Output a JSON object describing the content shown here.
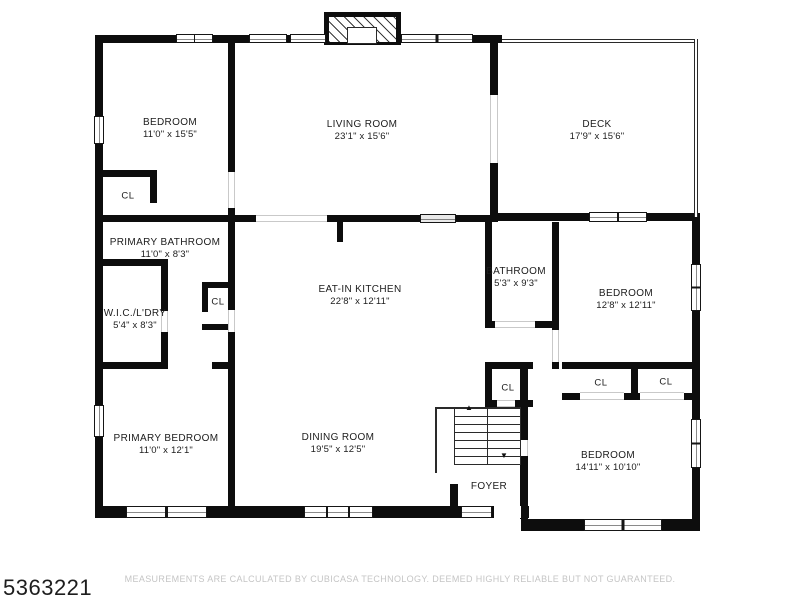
{
  "footer": {
    "listing_id": "5363221",
    "disclaimer": "MEASUREMENTS ARE CALCULATED BY CUBICASA TECHNOLOGY. DEEMED HIGHLY RELIABLE BUT NOT GUARANTEED."
  },
  "labels": {
    "closet": "CL"
  },
  "icons": {
    "stairs_up_arrow": "▲",
    "stairs_down_arrow": "▼"
  },
  "rooms": {
    "bedroom_tl": {
      "name": "BEDROOM",
      "dims": "11'0\" x 15'5\""
    },
    "living": {
      "name": "LIVING ROOM",
      "dims": "23'1\" x 15'6\""
    },
    "deck": {
      "name": "DECK",
      "dims": "17'9\" x 15'6\""
    },
    "primary_bathroom": {
      "name": "PRIMARY BATHROOM",
      "dims": "11'0\" x 8'3\""
    },
    "wic_laundry": {
      "name": "W.I.C./L'DRY",
      "dims": "5'4\" x 8'3\""
    },
    "eat_in_kitchen": {
      "name": "EAT-IN KITCHEN",
      "dims": "22'8\" x 12'11\""
    },
    "bathroom": {
      "name": "BATHROOM",
      "dims": "5'3\" x 9'3\""
    },
    "bedroom_right": {
      "name": "BEDROOM",
      "dims": "12'8\" x 12'11\""
    },
    "primary_bedroom": {
      "name": "PRIMARY BEDROOM",
      "dims": "11'0\" x 12'1\""
    },
    "dining": {
      "name": "DINING ROOM",
      "dims": "19'5\" x 12'5\""
    },
    "bedroom_br": {
      "name": "BEDROOM",
      "dims": "14'11\" x 10'10\""
    },
    "foyer": {
      "name": "FOYER"
    }
  }
}
